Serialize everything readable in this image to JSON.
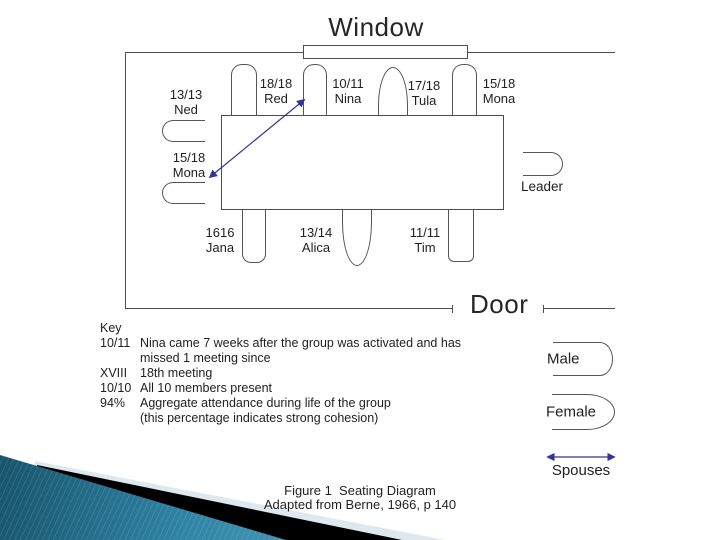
{
  "slide": {
    "room": {
      "window_label": "Window",
      "door_label": "Door"
    },
    "seats": {
      "red": {
        "ratio": "18/18",
        "name": "Red"
      },
      "nina": {
        "ratio": "10/11",
        "name": "Nina"
      },
      "tula": {
        "ratio": "17/18",
        "name": "Tula"
      },
      "mona_top": {
        "ratio": "15/18",
        "name": "Mona"
      },
      "ned": {
        "ratio": "13/13",
        "name": "Ned"
      },
      "mona_left": {
        "ratio": "15/18",
        "name": "Mona"
      },
      "leader": {
        "name": "Leader"
      },
      "jana": {
        "ratio": "1616",
        "name": "Jana"
      },
      "alica": {
        "ratio": "13/14",
        "name": "Alica"
      },
      "tim": {
        "ratio": "11/11",
        "name": "Tim"
      }
    },
    "key": {
      "title": "Key",
      "rows": [
        {
          "term": "10/11",
          "lines": [
            "Nina came 7 weeks after the group was activated and has",
            "missed 1 meeting since"
          ]
        },
        {
          "term": "XVIII",
          "lines": [
            "18th meeting"
          ]
        },
        {
          "term": "10/10",
          "lines": [
            "All 10 members present"
          ]
        },
        {
          "term": "94%",
          "lines": [
            "Aggregate attendance during life of the group",
            "(this percentage indicates strong cohesion)"
          ]
        }
      ]
    },
    "legend": {
      "male": "Male",
      "female": "Female",
      "spouses": "Spouses"
    },
    "caption": {
      "line1": "Figure 1  Seating Diagram",
      "line2": "Adapted from Berne, 1966, p 140"
    },
    "colors": {
      "diagram_line": "#4d4d4d",
      "text": "#1f1f1f",
      "arrow_blue": "#333399",
      "swoosh_teal": "#2e82a3",
      "swoosh_black": "#000000",
      "swoosh_pale": "#dde8ef"
    }
  }
}
